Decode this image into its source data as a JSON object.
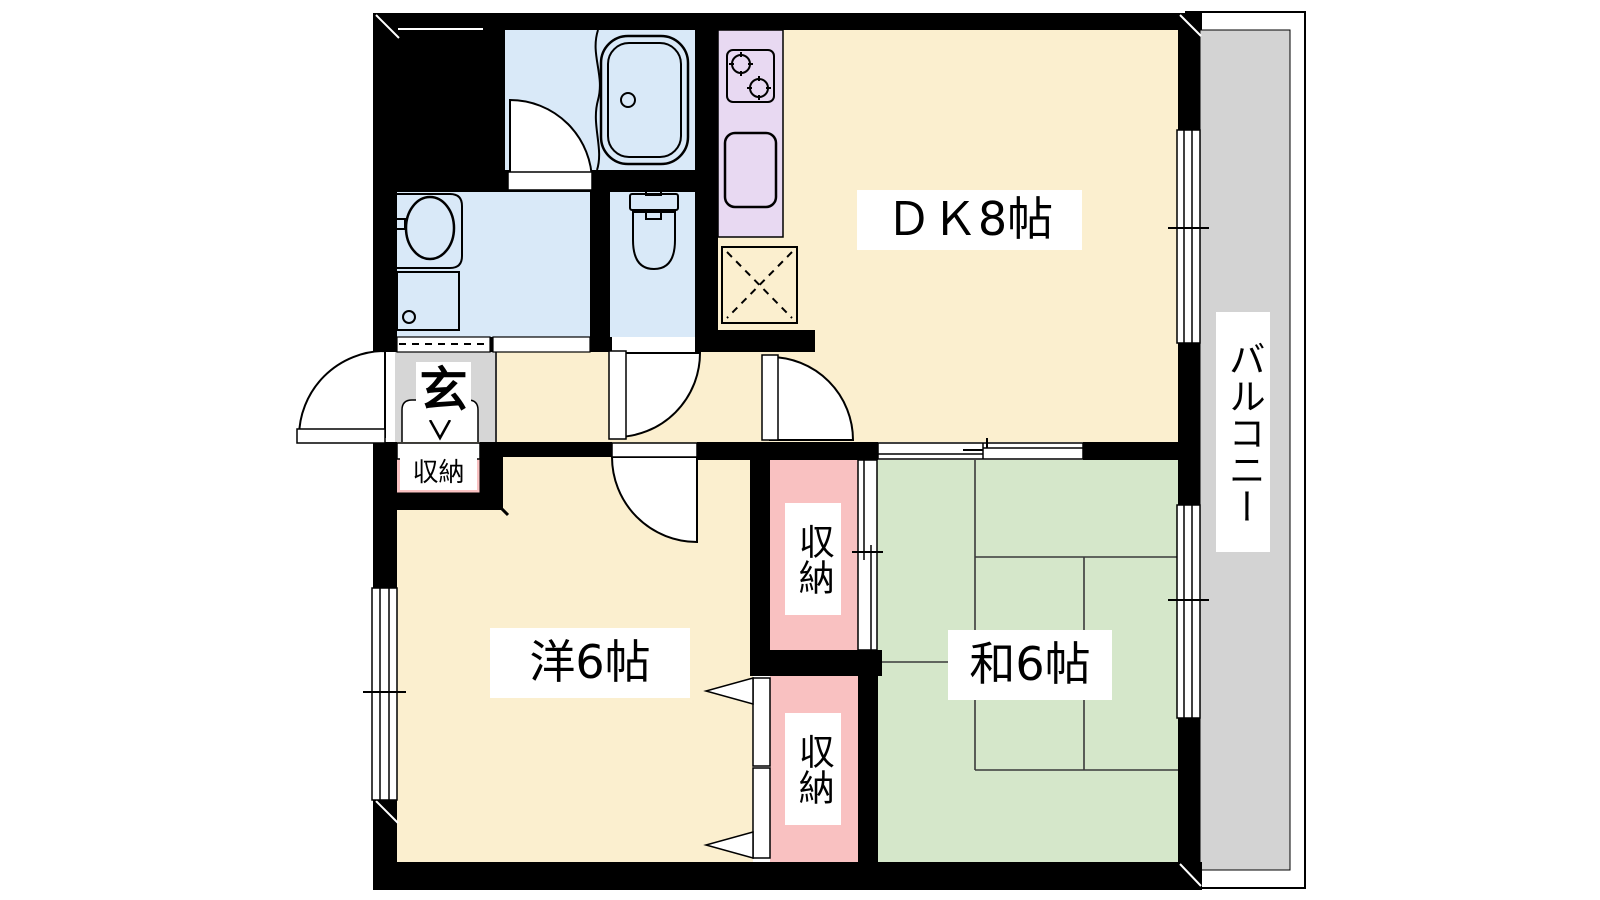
{
  "floor_plan": {
    "rooms": {
      "dining_kitchen": {
        "label": "ＤＫ8帖"
      },
      "western_room": {
        "label": "洋6帖"
      },
      "japanese_room": {
        "label": "和6帖"
      },
      "balcony": {
        "label": "バルコニー"
      },
      "entrance": {
        "label": "玄"
      },
      "entrance_closet": {
        "label": "収納"
      },
      "japanese_closet": {
        "label": "収納"
      },
      "western_closet": {
        "label": "収納"
      }
    },
    "colors": {
      "room_floor": "#FBEFCF",
      "tatami": "#D5E7CA",
      "wet_area": "#D9E9F8",
      "kitchen_counter": "#E8D9F2",
      "closet": "#F9C1C1",
      "balcony_floor": "#D3D3D3",
      "entrance_floor": "#D6D6D6",
      "wall": "#000000",
      "label_bg": "#FFFFFF"
    },
    "fixtures": [
      "bathtub",
      "toilet",
      "washbasin",
      "washing-machine-pan",
      "gas-stove",
      "kitchen-sink",
      "refrigerator-space"
    ]
  }
}
